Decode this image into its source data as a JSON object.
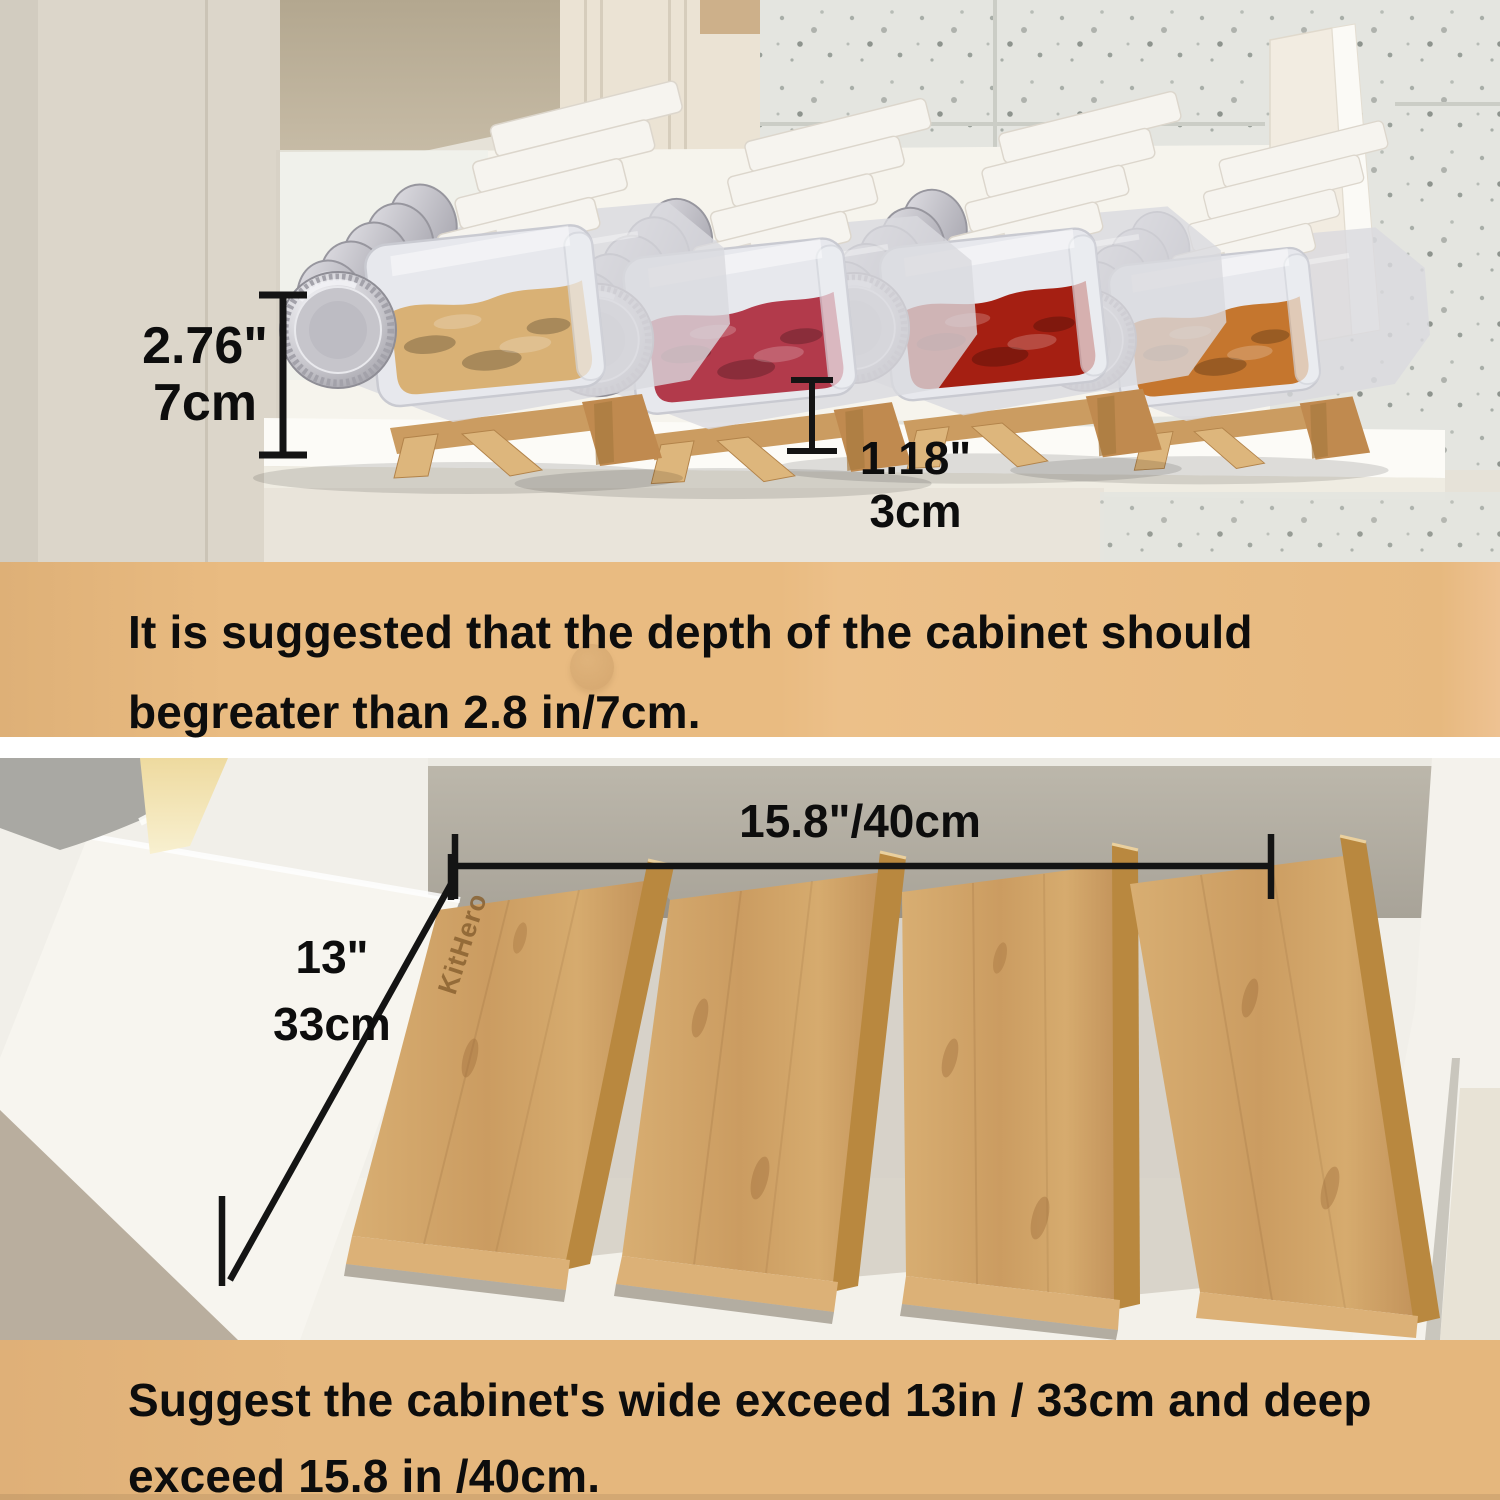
{
  "theme": {
    "band_bg": "#e9bb81",
    "band_bg2": "#e5b77d",
    "text_dark": "#0d0d0d",
    "dim_line": "#141414",
    "wood_light": "#ddb67c",
    "wood_mid": "#cb9c61",
    "wood_dark": "#b28049",
    "brand_engrave": "#8a6231",
    "lid_silver": "#c6c5cb",
    "label_white": "#f6f4ef",
    "glass": "#d9dade"
  },
  "top_photo": {
    "dim_height": {
      "line1": "2.76\"",
      "line2": "7cm"
    },
    "dim_base": {
      "line1": "1.18\"",
      "line2": "3cm"
    },
    "jar_groups": [
      {
        "name": "jar-row-dried-ginger",
        "color": "#d9b175"
      },
      {
        "name": "jar-row-rose-buds",
        "color": "#b23a4b"
      },
      {
        "name": "jar-row-chili-peppers",
        "color": "#a51f12"
      },
      {
        "name": "jar-row-dried-shrimp",
        "color": "#c5762e"
      }
    ]
  },
  "band_top": {
    "line1": "It is suggested that the depth of the cabinet should",
    "line2": "begreater than 2.8 in/7cm."
  },
  "bottom_photo": {
    "dim_width": "15.8\"/40cm",
    "dim_depth": {
      "line1": "13\"",
      "line2": "33cm"
    },
    "brand": "KitHero"
  },
  "band_bottom": {
    "line1": "Suggest the cabinet's wide exceed 13in / 33cm and deep",
    "line2": "exceed 15.8 in /40cm."
  }
}
